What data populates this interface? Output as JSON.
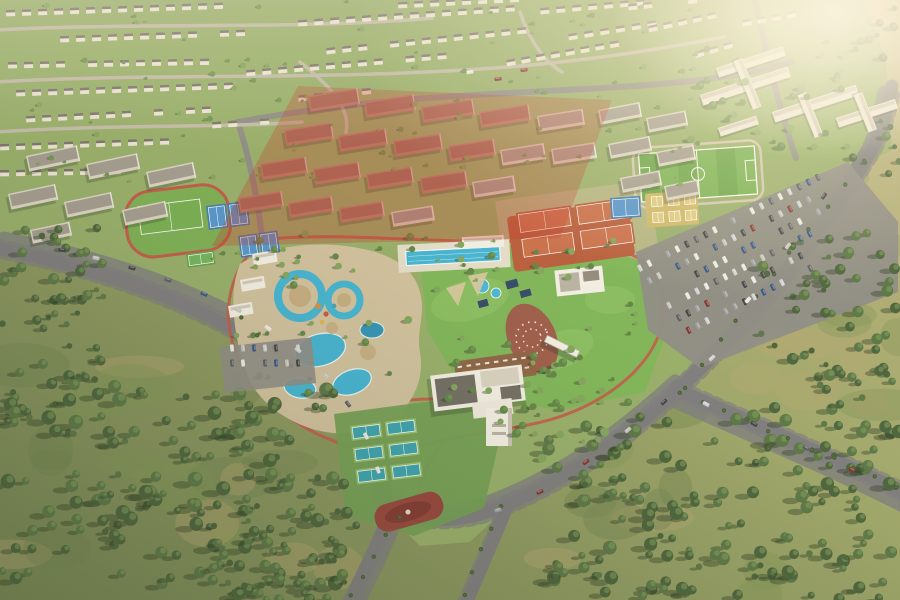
{
  "scene": {
    "label": "Aerial render of a residential master-planned community with central sports and leisure park, highlighted apartment parcel, villas, school campus, water park, tennis courts and surrounding scrubland",
    "palette": {
      "scrubA": "#9aa468",
      "scrubB": "#c0b381",
      "scrubC": "#7e9355",
      "scrubD": "#6f8150",
      "scrubTan": "#b3a671",
      "platform": "#94ad68",
      "lawn": "#7cb457",
      "lawnLight": "#8fc468",
      "roadMain": "#7b7a7e",
      "roadSec": "#8b8a85",
      "villaLane": "#c0b9a8",
      "medianOrange": "#d07c35",
      "trackRed": "#c05648",
      "plazaRed": "#93413a",
      "plazaRedDark": "#7d352f",
      "plazaTerra": "#9a5a48",
      "pathTerracotta": "#b4614d",
      "sand": "#cfc09e",
      "sandDark": "#c2ab80",
      "poolBlue": "#3eb3d4",
      "poolDeep": "#2d92b7",
      "clay": "#b65a3a",
      "clayCourt": "#c76d49",
      "padelSand": "#cdb666",
      "padelCourt": "#dcc97f",
      "courtBlue": "#3b78b5",
      "courtBlueIn": "#4f93cd",
      "courtTeal": "#36a1af",
      "courtTealDark": "#2b8d9e",
      "apron": "#6f9c52",
      "courtFrame": "#8fbf6f",
      "pitchA": "#66a345",
      "pitchB": "#74b150",
      "fieldGreen": "#74ad50",
      "courtGreen": "#61a14c",
      "villaWall": "#ebe5d6",
      "roofDark": "#6b675e",
      "aptSalmon": "#b98273",
      "aptSalmonRoof": "#9c6a5c",
      "aptWhite": "#d9d3c5",
      "aptWhiteRoof": "#9a948a",
      "schoolWhite": "#eeeae0",
      "schoolRoof": "#cfc9bb",
      "deckWood": "#8a5e42",
      "navy": "#2e4668",
      "white": "#f2efe6",
      "treeScrubA": "#46603a",
      "treeScrubB": "#567344",
      "treePark": "#5d8345",
      "treeVilla": "#6d9350",
      "treeLight": "#7fa35c",
      "shadow": "rgba(35,52,28,0.38)",
      "buildingShadow": "rgba(40,50,35,0.28)",
      "overlayRed": "rgba(194,52,40,0.30)",
      "hazeA": "#fff3d6",
      "hazeB": "#fff9e8",
      "vignette": "rgba(33,44,27,0.16)"
    },
    "carColors": [
      "#e9e9e7",
      "#cdd2d6",
      "#9aa0a6",
      "#54585f",
      "#7d2f2a",
      "#31507f",
      "#c4c4bf",
      "#3a3d42"
    ],
    "redZone": "298,86 612,100 560,238 212,246",
    "villaRows": [
      [
        6,
        10,
        -2,
        15,
        16
      ],
      [
        298,
        20,
        -4,
        14,
        16
      ],
      [
        540,
        8,
        -5,
        7,
        16
      ],
      [
        60,
        36,
        -2,
        13,
        16
      ],
      [
        326,
        48,
        -6,
        13,
        16
      ],
      [
        568,
        34,
        -9,
        6,
        16
      ],
      [
        8,
        62,
        -1,
        13,
        16
      ],
      [
        246,
        70,
        -5,
        13,
        16
      ],
      [
        506,
        60,
        -10,
        8,
        15
      ],
      [
        648,
        26,
        -12,
        5,
        15
      ],
      [
        16,
        90,
        -2,
        14,
        16
      ],
      [
        282,
        97,
        -6,
        6,
        16
      ],
      [
        26,
        116,
        -3,
        12,
        16
      ],
      [
        212,
        122,
        -4,
        4,
        16
      ],
      [
        0,
        144,
        -2,
        11,
        16
      ],
      [
        0,
        170,
        -1,
        8,
        16
      ],
      [
        398,
        2,
        -3,
        8,
        16
      ],
      [
        628,
        4,
        -6,
        5,
        15
      ],
      [
        694,
        52,
        -16,
        4,
        15
      ],
      [
        742,
        20,
        -10,
        4,
        15
      ]
    ],
    "apartments": [
      [
        308,
        96,
        50,
        16,
        -9,
        "r"
      ],
      [
        364,
        102,
        50,
        16,
        -9,
        "r"
      ],
      [
        421,
        107,
        52,
        16,
        -9,
        "r"
      ],
      [
        479,
        112,
        50,
        16,
        -9,
        "r"
      ],
      [
        537,
        116,
        46,
        16,
        -9,
        "w"
      ],
      [
        284,
        130,
        48,
        16,
        -9,
        "r"
      ],
      [
        338,
        136,
        48,
        16,
        -9,
        "r"
      ],
      [
        393,
        141,
        48,
        16,
        -9,
        "r"
      ],
      [
        448,
        146,
        46,
        16,
        -9,
        "r"
      ],
      [
        500,
        150,
        44,
        16,
        -9,
        "w"
      ],
      [
        551,
        149,
        44,
        16,
        -9,
        "w"
      ],
      [
        260,
        164,
        46,
        16,
        -9,
        "r"
      ],
      [
        313,
        169,
        46,
        16,
        -9,
        "r"
      ],
      [
        366,
        174,
        46,
        16,
        -9,
        "r"
      ],
      [
        420,
        178,
        46,
        16,
        -9,
        "r"
      ],
      [
        472,
        182,
        42,
        16,
        -9,
        "w"
      ],
      [
        238,
        198,
        44,
        15,
        -9,
        "r"
      ],
      [
        288,
        203,
        44,
        15,
        -9,
        "r"
      ],
      [
        339,
        208,
        44,
        15,
        -9,
        "r"
      ],
      [
        391,
        212,
        42,
        15,
        -9,
        "w"
      ],
      [
        598,
        110,
        42,
        15,
        -11,
        "w"
      ],
      [
        646,
        118,
        40,
        15,
        -11,
        "w"
      ],
      [
        608,
        144,
        42,
        15,
        -11,
        "w"
      ],
      [
        656,
        152,
        38,
        15,
        -11,
        "w"
      ],
      [
        620,
        178,
        40,
        15,
        -11,
        "w"
      ],
      [
        664,
        186,
        34,
        15,
        -11,
        "w"
      ],
      [
        26,
        156,
        52,
        16,
        -12,
        "w"
      ],
      [
        86,
        164,
        52,
        16,
        -12,
        "w"
      ],
      [
        146,
        172,
        48,
        16,
        -12,
        "w"
      ],
      [
        8,
        194,
        48,
        16,
        -12,
        "w"
      ],
      [
        64,
        202,
        48,
        16,
        -12,
        "w"
      ],
      [
        122,
        210,
        44,
        16,
        -12,
        "w"
      ],
      [
        30,
        230,
        40,
        14,
        -12,
        "w"
      ]
    ],
    "schoolSlabs": [
      [
        700,
        95,
        92,
        11,
        -18
      ],
      [
        716,
        68,
        70,
        10,
        -18
      ],
      [
        772,
        112,
        88,
        11,
        -18
      ],
      [
        742,
        58,
        52,
        9,
        68
      ],
      [
        806,
        92,
        46,
        9,
        68
      ],
      [
        836,
        118,
        62,
        10,
        -18
      ],
      [
        862,
        92,
        40,
        9,
        68
      ],
      [
        718,
        128,
        40,
        9,
        -18
      ]
    ],
    "pavilions": [
      [
        252,
        254
      ],
      [
        240,
        280
      ],
      [
        228,
        306
      ]
    ],
    "treeClusters": [
      {
        "x": 0,
        "y": 385,
        "w": 345,
        "h": 215,
        "n": 150,
        "rMin": 3,
        "rMax": 7.5,
        "kind": "scrub",
        "dx": -7,
        "dy": 3
      },
      {
        "x": 545,
        "y": 415,
        "w": 355,
        "h": 185,
        "n": 150,
        "rMin": 3,
        "rMax": 7,
        "kind": "scrub",
        "dx": -7,
        "dy": 3
      },
      {
        "x": 195,
        "y": 505,
        "w": 165,
        "h": 95,
        "n": 45,
        "rMin": 2.5,
        "rMax": 6,
        "kind": "scrub",
        "dx": -6,
        "dy": 3
      },
      {
        "x": 0,
        "y": 225,
        "w": 105,
        "h": 160,
        "n": 48,
        "rMin": 2.5,
        "rMax": 6,
        "kind": "scrub",
        "dx": -6,
        "dy": 2
      },
      {
        "x": 756,
        "y": 230,
        "w": 144,
        "h": 180,
        "n": 55,
        "rMin": 2.5,
        "rMax": 6,
        "kind": "scrub",
        "dx": -6,
        "dy": 2
      },
      {
        "x": 852,
        "y": 0,
        "w": 48,
        "h": 175,
        "n": 16,
        "rMin": 2,
        "rMax": 5,
        "kind": "scrub",
        "dx": -5,
        "dy": 2
      },
      {
        "x": 228,
        "y": 232,
        "w": 420,
        "h": 175,
        "n": 55,
        "rMin": 1.8,
        "rMax": 4,
        "kind": "park",
        "dx": -3,
        "dy": 2
      },
      {
        "x": 0,
        "y": 0,
        "w": 700,
        "h": 185,
        "n": 95,
        "rMin": 1.4,
        "rMax": 3,
        "kind": "villa",
        "dx": -2,
        "dy": 1
      },
      {
        "x": 688,
        "y": 35,
        "w": 180,
        "h": 115,
        "n": 30,
        "rMin": 2,
        "rMax": 4.5,
        "kind": "park",
        "dx": -4,
        "dy": 2
      },
      {
        "x": 205,
        "y": 238,
        "w": 420,
        "h": 30,
        "n": 22,
        "rMin": 1.6,
        "rMax": 3.4,
        "kind": "park",
        "dx": -3,
        "dy": 1
      },
      {
        "x": 500,
        "y": 350,
        "w": 130,
        "h": 110,
        "n": 30,
        "rMin": 2,
        "rMax": 4.5,
        "kind": "park",
        "dx": -4,
        "dy": 2
      }
    ],
    "parkingCars": {
      "x": 640,
      "y": 268,
      "angle": -27,
      "rows": 6,
      "perRow": 20,
      "gapAlong": 10.5,
      "rowGap": 15.5
    },
    "smallLot": {
      "x": 232,
      "y": 352,
      "angle": -6,
      "rows": 2,
      "perRow": 7,
      "gapAlong": 11,
      "rowGap": 15
    },
    "roadCars": [
      [
        62,
        250,
        10
      ],
      [
        96,
        258,
        12
      ],
      [
        132,
        268,
        15
      ],
      [
        168,
        280,
        18
      ],
      [
        204,
        294,
        22
      ],
      [
        238,
        310,
        27
      ],
      [
        268,
        328,
        33
      ],
      [
        298,
        350,
        38
      ],
      [
        326,
        376,
        45
      ],
      [
        348,
        404,
        52
      ],
      [
        366,
        436,
        60
      ],
      [
        378,
        470,
        68
      ],
      [
        498,
        510,
        -18
      ],
      [
        540,
        492,
        -26
      ],
      [
        586,
        462,
        -34
      ],
      [
        628,
        430,
        -40
      ],
      [
        664,
        402,
        -44
      ],
      [
        706,
        404,
        28
      ],
      [
        754,
        424,
        29
      ],
      [
        806,
        448,
        30
      ],
      [
        852,
        470,
        30
      ],
      [
        470,
        72,
        -8
      ],
      [
        498,
        79,
        -8
      ],
      [
        524,
        70,
        -8
      ],
      [
        712,
        358,
        -42
      ],
      [
        748,
        300,
        -48
      ],
      [
        788,
        246,
        -52
      ],
      [
        824,
        196,
        -55
      ]
    ],
    "palmLines": [
      [
        680,
        392,
        898,
        486,
        11
      ],
      [
        684,
        386,
        862,
        162,
        11
      ],
      [
        398,
        516,
        352,
        596,
        5
      ],
      [
        500,
        506,
        464,
        596,
        5
      ],
      [
        310,
        380,
        240,
        318,
        5
      ]
    ]
  }
}
